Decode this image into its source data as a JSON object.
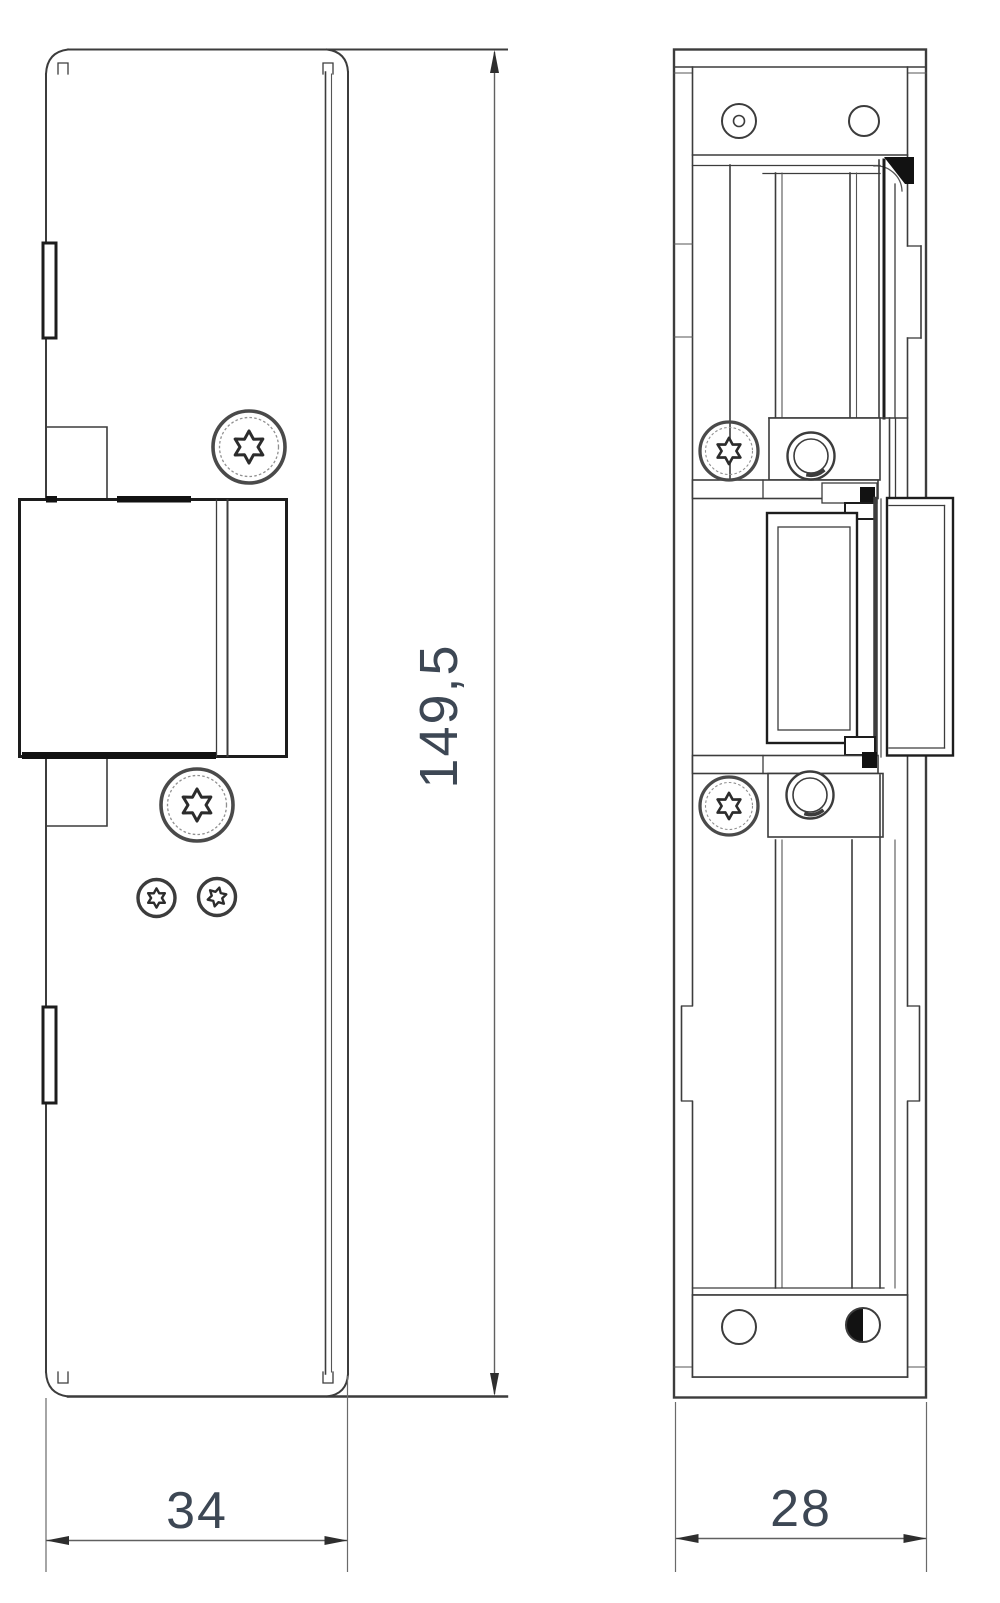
{
  "drawing": {
    "dimensions": {
      "overall_height": "149,5",
      "front_width": "34",
      "side_depth": "28"
    },
    "colors": {
      "background": "#ffffff",
      "line": "#3c3c3c",
      "dim_text": "#3d4754"
    }
  }
}
